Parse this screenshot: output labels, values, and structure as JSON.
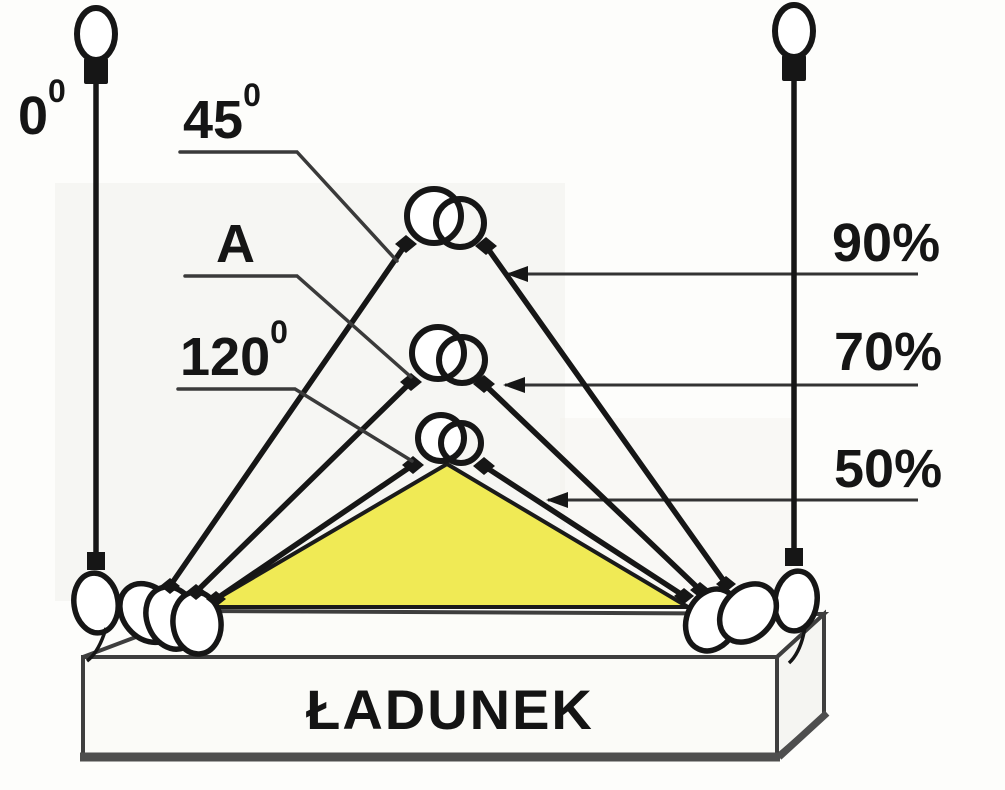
{
  "diagram": {
    "description": "sling-angle-vs-capacity-diagram",
    "labels": {
      "deg0": {
        "base": "0",
        "sup": "0"
      },
      "deg45": {
        "base": "45",
        "sup": "0"
      },
      "pointA": {
        "base": "A"
      },
      "deg120": {
        "base": "120",
        "sup": "0"
      }
    },
    "capacities": {
      "cap90": "90%",
      "cap70": "70%",
      "cap50": "50%"
    },
    "load_label": "ŁADUNEK",
    "colors": {
      "highlight": "#f0ea55",
      "line": "#161616",
      "box_edge": "#3e3e3e"
    }
  }
}
